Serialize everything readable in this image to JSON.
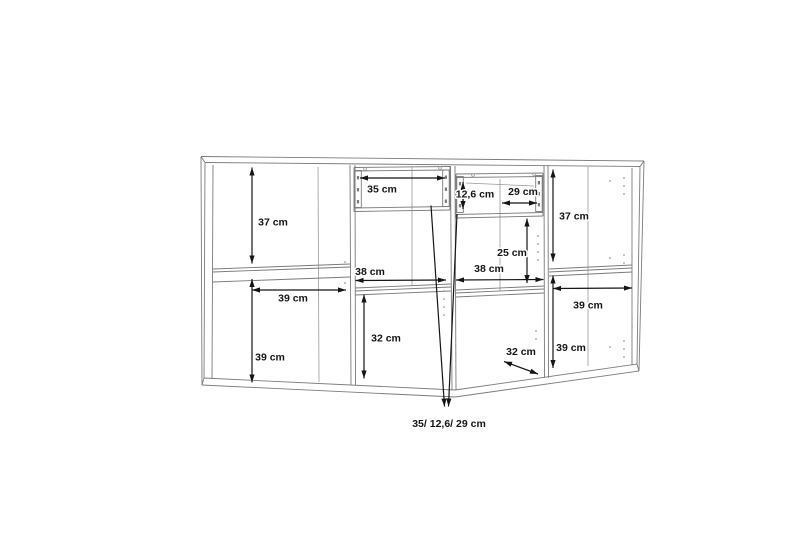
{
  "meta": {
    "width": 800,
    "height": 533,
    "background": "#ffffff",
    "kind": "furniture-dimension-drawing",
    "unit": "cm"
  },
  "styles": {
    "outline_color": "#7b7b7b",
    "interior_color": "#9a9a9a",
    "dimension_color": "#151515",
    "label_color": "#151515",
    "halo_color": "#ffffff",
    "outline_width": 0.9,
    "interior_width": 0.8,
    "dimension_width": 1.2,
    "label_font_size": 10.5,
    "note_font_size": 10.5
  },
  "measurements": {
    "sections": [
      {
        "position": "left",
        "values": [
          "37 cm",
          "39 cm",
          "39 cm"
        ]
      },
      {
        "position": "center-left",
        "values": [
          "35 cm",
          "38 cm",
          "32 cm"
        ]
      },
      {
        "position": "center-right",
        "values": [
          "12,6 cm",
          "29 cm",
          "25 cm",
          "38 cm",
          "32 cm"
        ]
      },
      {
        "position": "right",
        "values": [
          "37 cm",
          "39 cm",
          "39 cm"
        ]
      }
    ],
    "drawer_note": "35/ 12,6/ 29 cm"
  },
  "wireframe": {
    "polylines": [
      {
        "name": "top-back-edge",
        "cls": "outline",
        "pts": [
          [
            201,
            156.5
          ],
          [
            644,
            161
          ]
        ]
      },
      {
        "name": "top-front-edge",
        "cls": "outline",
        "pts": [
          [
            205,
            162.5
          ],
          [
            640,
            166.5
          ]
        ]
      },
      {
        "name": "top-left-end",
        "cls": "outline",
        "pts": [
          [
            201,
            156.5
          ],
          [
            205,
            162.5
          ]
        ]
      },
      {
        "name": "top-right-end",
        "cls": "outline",
        "pts": [
          [
            644,
            161
          ],
          [
            640,
            166.5
          ]
        ]
      },
      {
        "name": "bottom-front-edge",
        "cls": "outline",
        "pts": [
          [
            204,
            378
          ],
          [
            455,
            390
          ],
          [
            637,
            364
          ]
        ]
      },
      {
        "name": "bottom-under-edge",
        "cls": "outline",
        "pts": [
          [
            202,
            385
          ],
          [
            455,
            397
          ],
          [
            639,
            371
          ]
        ]
      },
      {
        "name": "bottom-left-end",
        "cls": "outline",
        "pts": [
          [
            204,
            378
          ],
          [
            202,
            385
          ]
        ]
      },
      {
        "name": "bottom-right-end",
        "cls": "outline",
        "pts": [
          [
            637,
            364
          ],
          [
            639,
            371
          ]
        ]
      },
      {
        "name": "left-outer-edge",
        "cls": "outline",
        "pts": [
          [
            201,
            157
          ],
          [
            202,
            385
          ]
        ]
      },
      {
        "name": "left-front-edge",
        "cls": "outline",
        "pts": [
          [
            205,
            163
          ],
          [
            204,
            378
          ]
        ]
      },
      {
        "name": "left-inner-edge",
        "cls": "outline",
        "pts": [
          [
            213,
            165
          ],
          [
            212,
            379
          ]
        ]
      },
      {
        "name": "right-outer-edge",
        "cls": "outline",
        "pts": [
          [
            644,
            161
          ],
          [
            639,
            371
          ]
        ]
      },
      {
        "name": "right-front-edge",
        "cls": "outline",
        "pts": [
          [
            640,
            167
          ],
          [
            637,
            364
          ]
        ]
      },
      {
        "name": "right-inner-edge",
        "cls": "outline",
        "pts": [
          [
            632,
            168
          ],
          [
            632,
            365
          ]
        ]
      },
      {
        "name": "divider1-left",
        "cls": "outline",
        "pts": [
          [
            350,
            165
          ],
          [
            351,
            385.5
          ]
        ]
      },
      {
        "name": "divider1-right",
        "cls": "outline",
        "pts": [
          [
            355,
            165
          ],
          [
            355.5,
            385.5
          ]
        ]
      },
      {
        "name": "divider2-left",
        "cls": "outline",
        "pts": [
          [
            450.5,
            166
          ],
          [
            452,
            390
          ]
        ]
      },
      {
        "name": "divider2-right",
        "cls": "outline",
        "pts": [
          [
            455,
            166
          ],
          [
            456,
            390
          ]
        ]
      },
      {
        "name": "divider3-left",
        "cls": "outline",
        "pts": [
          [
            544,
            165
          ],
          [
            544.5,
            378
          ]
        ]
      },
      {
        "name": "divider3-right",
        "cls": "outline",
        "pts": [
          [
            548,
            165
          ],
          [
            548.5,
            378
          ]
        ]
      },
      {
        "name": "interior-corner-1",
        "cls": "interior",
        "pts": [
          [
            318,
            167
          ],
          [
            319,
            382
          ]
        ]
      },
      {
        "name": "interior-corner-2",
        "cls": "interior",
        "pts": [
          [
            412,
            167
          ],
          [
            412,
            286
          ]
        ]
      },
      {
        "name": "interior-corner-3",
        "cls": "interior",
        "pts": [
          [
            500,
            179
          ],
          [
            500,
            291
          ]
        ]
      },
      {
        "name": "interior-corner-4",
        "cls": "interior",
        "pts": [
          [
            588,
            167
          ],
          [
            588,
            366
          ]
        ]
      },
      {
        "name": "shelf1-top",
        "cls": "outline",
        "pts": [
          [
            213,
            269
          ],
          [
            350,
            264
          ]
        ]
      },
      {
        "name": "shelf1-mid",
        "cls": "outline",
        "pts": [
          [
            213,
            272
          ],
          [
            350,
            267
          ]
        ]
      },
      {
        "name": "shelf1-bottom",
        "cls": "outline",
        "pts": [
          [
            213,
            282
          ],
          [
            350,
            277
          ]
        ]
      },
      {
        "name": "shelf2-top",
        "cls": "outline",
        "pts": [
          [
            355,
            288
          ],
          [
            451,
            284
          ]
        ]
      },
      {
        "name": "shelf2-mid",
        "cls": "outline",
        "pts": [
          [
            355,
            291
          ],
          [
            451,
            287
          ]
        ]
      },
      {
        "name": "shelf2-bottom",
        "cls": "outline",
        "pts": [
          [
            355,
            295
          ],
          [
            451,
            291
          ]
        ]
      },
      {
        "name": "shelf3-top",
        "cls": "outline",
        "pts": [
          [
            456,
            290
          ],
          [
            544,
            286
          ]
        ]
      },
      {
        "name": "shelf3-mid",
        "cls": "outline",
        "pts": [
          [
            456,
            293
          ],
          [
            544,
            289
          ]
        ]
      },
      {
        "name": "shelf3-bottom",
        "cls": "outline",
        "pts": [
          [
            456,
            297
          ],
          [
            544,
            293
          ]
        ]
      },
      {
        "name": "shelf4-top",
        "cls": "outline",
        "pts": [
          [
            549,
            269
          ],
          [
            632,
            265
          ]
        ]
      },
      {
        "name": "shelf4-mid",
        "cls": "outline",
        "pts": [
          [
            549,
            272
          ],
          [
            632,
            268
          ]
        ]
      },
      {
        "name": "shelf4-bottom",
        "cls": "outline",
        "pts": [
          [
            549,
            276
          ],
          [
            632,
            272
          ]
        ]
      },
      {
        "name": "drawer1-top",
        "cls": "outline",
        "pts": [
          [
            354,
            167.5
          ],
          [
            450,
            166.5
          ]
        ]
      },
      {
        "name": "drawer1-top-inner",
        "cls": "outline",
        "pts": [
          [
            354,
            171
          ],
          [
            450,
            170
          ]
        ]
      },
      {
        "name": "drawer1-bottom",
        "cls": "outline",
        "pts": [
          [
            354,
            208
          ],
          [
            450,
            206.5
          ]
        ]
      },
      {
        "name": "drawer1-bottom2",
        "cls": "outline",
        "pts": [
          [
            354,
            211.5
          ],
          [
            450,
            210
          ]
        ]
      },
      {
        "name": "drawer1-left",
        "cls": "outline",
        "pts": [
          [
            354,
            167.5
          ],
          [
            354,
            211.5
          ]
        ]
      },
      {
        "name": "drawer1-right",
        "cls": "outline",
        "pts": [
          [
            450,
            166.5
          ],
          [
            450,
            210
          ]
        ]
      },
      {
        "name": "drawer2-top",
        "cls": "outline",
        "pts": [
          [
            456,
            174
          ],
          [
            543,
            173
          ]
        ]
      },
      {
        "name": "drawer2-top-inner",
        "cls": "outline",
        "pts": [
          [
            456,
            177.5
          ],
          [
            543,
            176.5
          ]
        ]
      },
      {
        "name": "drawer2-bottom",
        "cls": "outline",
        "pts": [
          [
            456,
            214.5
          ],
          [
            543,
            212.5
          ]
        ]
      },
      {
        "name": "drawer2-bottom2",
        "cls": "outline",
        "pts": [
          [
            456,
            218
          ],
          [
            543,
            216
          ]
        ]
      },
      {
        "name": "drawer2-left",
        "cls": "outline",
        "pts": [
          [
            456,
            174
          ],
          [
            456,
            218
          ]
        ]
      },
      {
        "name": "drawer2-right",
        "cls": "outline",
        "pts": [
          [
            543,
            173
          ],
          [
            543,
            216
          ]
        ]
      },
      {
        "name": "drawer2-inner-edge",
        "cls": "interior",
        "pts": [
          [
            466,
            183
          ],
          [
            534,
            186
          ]
        ]
      }
    ],
    "rail_rects": [
      {
        "name": "drawer1-left-slide",
        "x": 354.8,
        "y": 170.5,
        "w": 6.5,
        "h": 37
      },
      {
        "name": "drawer1-right-slide",
        "x": 442.7,
        "y": 170,
        "w": 6.5,
        "h": 36.5
      },
      {
        "name": "drawer2-left-slide",
        "x": 456.8,
        "y": 176.5,
        "w": 6.5,
        "h": 36
      },
      {
        "name": "drawer2-right-slide",
        "x": 535.7,
        "y": 175.5,
        "w": 6.5,
        "h": 36
      }
    ],
    "rail_ticks": [
      [
        356.9,
        176
      ],
      [
        356.9,
        188
      ],
      [
        356.9,
        200
      ],
      [
        444.8,
        175.5
      ],
      [
        444.8,
        187.5
      ],
      [
        444.8,
        199.5
      ],
      [
        458.9,
        182
      ],
      [
        458.9,
        193
      ],
      [
        458.9,
        204
      ],
      [
        537.8,
        181
      ],
      [
        537.8,
        192
      ],
      [
        537.8,
        203
      ]
    ],
    "screw_holes": [
      [
        365,
        169
      ],
      [
        440,
        168
      ],
      [
        473,
        175
      ],
      [
        534,
        174
      ]
    ],
    "pin_holes": [
      [
        345,
        262
      ],
      [
        345,
        283
      ],
      [
        444,
        291
      ],
      [
        444,
        299
      ],
      [
        444,
        307
      ],
      [
        444,
        315
      ],
      [
        538,
        236
      ],
      [
        538,
        244
      ],
      [
        538,
        252
      ],
      [
        538,
        260
      ],
      [
        536,
        331
      ],
      [
        536,
        339
      ],
      [
        610,
        181
      ],
      [
        624,
        178
      ],
      [
        624,
        186
      ],
      [
        624,
        194
      ],
      [
        610,
        258
      ],
      [
        624,
        255
      ],
      [
        624,
        263
      ],
      [
        610,
        347
      ],
      [
        624,
        341
      ],
      [
        624,
        349
      ],
      [
        624,
        357
      ]
    ]
  },
  "dimensions": [
    {
      "id": "left-upper-height",
      "text": "37 cm",
      "line": [
        252,
        167.5,
        252,
        263.5
      ],
      "label": [
        273,
        222
      ]
    },
    {
      "id": "left-width",
      "text": "39 cm",
      "line": [
        252,
        290,
        346,
        290
      ],
      "label": [
        293,
        298
      ]
    },
    {
      "id": "left-lower-height",
      "text": "39 cm",
      "line": [
        252,
        279,
        252,
        382.5
      ],
      "label": [
        270,
        357
      ]
    },
    {
      "id": "drawer1-width",
      "text": "35 cm",
      "line": [
        360,
        178,
        445,
        178
      ],
      "label": [
        382,
        189
      ]
    },
    {
      "id": "mid-left-width",
      "text": "38 cm",
      "line": [
        355.5,
        280.5,
        446,
        280
      ],
      "label": [
        370,
        271.5
      ]
    },
    {
      "id": "mid-left-height",
      "text": "32 cm",
      "line": [
        364,
        294.5,
        364,
        378.5
      ],
      "label": [
        386,
        338
      ]
    },
    {
      "id": "drawer2-height",
      "text": "12,6 cm",
      "line": [
        463,
        182,
        463,
        209
      ],
      "label": [
        475,
        194
      ]
    },
    {
      "id": "drawer2-depth",
      "text": "29 cm",
      "line": [
        502,
        203,
        537,
        203
      ],
      "label": [
        523,
        191.5
      ]
    },
    {
      "id": "mid-right-opening",
      "text": "25 cm",
      "line": [
        527,
        218.5,
        527,
        283
      ],
      "label": [
        512,
        252.5
      ]
    },
    {
      "id": "mid-right-width",
      "text": "38 cm",
      "line": [
        456,
        280,
        543.5,
        279.5
      ],
      "label": [
        489,
        268.5
      ]
    },
    {
      "id": "mid-right-depth",
      "text": "32 cm",
      "line": [
        504,
        361.5,
        538,
        374
      ],
      "label": [
        521,
        351.5
      ]
    },
    {
      "id": "right-upper-height",
      "text": "37 cm",
      "line": [
        553,
        169.5,
        553,
        261.5
      ],
      "label": [
        574,
        216
      ]
    },
    {
      "id": "right-width",
      "text": "39 cm",
      "line": [
        553,
        288.5,
        632,
        288
      ],
      "label": [
        588,
        305
      ]
    },
    {
      "id": "right-lower-height",
      "text": "39 cm",
      "line": [
        553,
        275.5,
        553,
        368
      ],
      "label": [
        571,
        347.5
      ]
    }
  ],
  "leaders": [
    {
      "name": "drawer1-leader",
      "line": [
        431,
        205.5,
        444.5,
        406.5
      ]
    },
    {
      "name": "drawer2-leader",
      "line": [
        457,
        214,
        448.5,
        406.5
      ]
    }
  ],
  "note": {
    "text": "35/ 12,6/ 29 cm",
    "x": 449,
    "y": 423.5
  }
}
